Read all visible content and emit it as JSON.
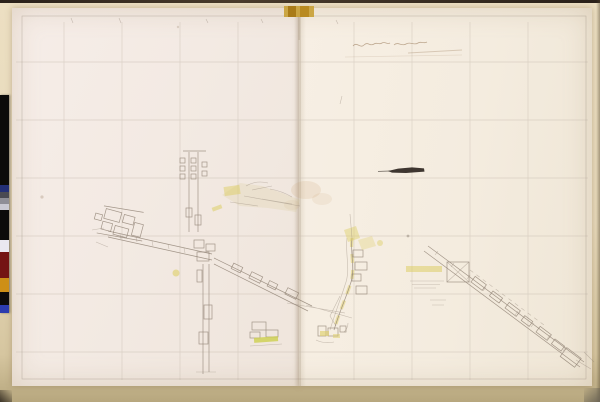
{
  "scan": {
    "handwritten_title_text": "",
    "legible_text_present": false
  },
  "colors": {
    "background_dark": "#1b140d",
    "mat": "#e7d9ba",
    "paper_left": "#f4ebe5",
    "paper_right": "#f5eee2",
    "fold_line": "#b3a28c",
    "tape_gold": "#c9a23c",
    "ink": "#8f8173",
    "grid": "#c6bbae",
    "highlight_yellow": "#ddce66",
    "highlight_green": "#cdd04e",
    "smudge_black": "#241d17",
    "stain_brown": "#c59a6a"
  },
  "colorbar": {
    "segments": [
      {
        "name": "black",
        "color": "#0c0b0a",
        "h": 90
      },
      {
        "name": "navy-blue",
        "color": "#232f76",
        "h": 7
      },
      {
        "name": "dark-gray",
        "color": "#4a4a52",
        "h": 6
      },
      {
        "name": "mid-gray",
        "color": "#8e8e96",
        "h": 6
      },
      {
        "name": "light-gray",
        "color": "#c9c9d2",
        "h": 6
      },
      {
        "name": "black",
        "color": "#0c0b0a",
        "h": 30
      },
      {
        "name": "white",
        "color": "#eae8f1",
        "h": 12
      },
      {
        "name": "maroon",
        "color": "#741413",
        "h": 26
      },
      {
        "name": "gold",
        "color": "#cd8f16",
        "h": 14
      },
      {
        "name": "black",
        "color": "#0c0b0a",
        "h": 13
      },
      {
        "name": "blue",
        "color": "#2c3cae",
        "h": 8
      }
    ]
  }
}
